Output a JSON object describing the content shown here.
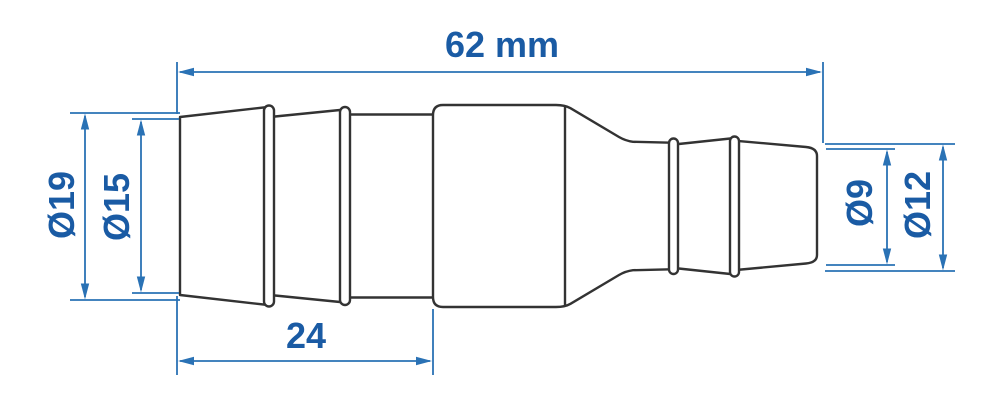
{
  "drawing": {
    "kind": "technical-dimension-drawing",
    "part": "reducing hose barb connector, side view",
    "labels": {
      "overall_length": "62 mm",
      "barb_length": "24",
      "dia_large_outer": "Ø19",
      "dia_large_inner": "Ø15",
      "dia_small_inner": "Ø9",
      "dia_small_outer": "Ø12"
    },
    "colors": {
      "dimension_line": "#2a72b5",
      "label_text": "#1a5ba4",
      "part_outline": "#333333"
    }
  }
}
